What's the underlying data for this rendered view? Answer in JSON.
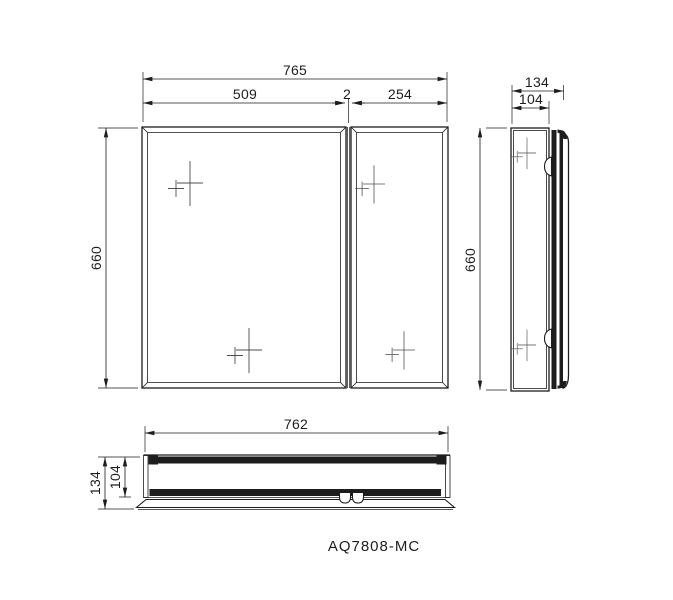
{
  "meta": {
    "model_label": "AQ7808-MC",
    "drawing_type": "mirror-cabinet-dimension-drawing"
  },
  "colors": {
    "line": "#1d1d1d",
    "background": "#ffffff"
  },
  "views": {
    "front": {
      "title": "front-view",
      "dims": {
        "overall_width": "765",
        "left_panel_width": "509",
        "center_gap": "2",
        "right_panel_width": "254",
        "height": "660"
      }
    },
    "side": {
      "title": "side-view",
      "dims": {
        "overall_depth": "134",
        "cabinet_depth": "104",
        "height": "660"
      }
    },
    "bottom": {
      "title": "bottom-view",
      "dims": {
        "width": "762",
        "overall_depth": "134",
        "cabinet_depth": "104"
      }
    }
  }
}
